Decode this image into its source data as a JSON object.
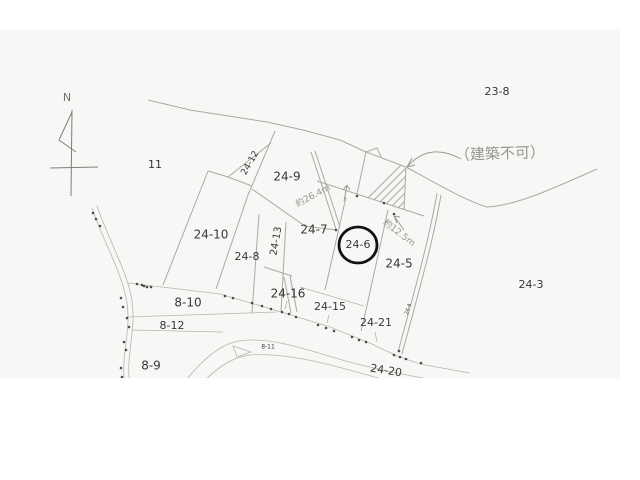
{
  "map": {
    "description": "cadastral-parcel-sketch",
    "scan_background": "#f7f7f5",
    "page_background": "#ffffff",
    "line_color": "#a9a9a5",
    "text_color": "#383836",
    "handwriting_color": "#97958e",
    "highlight_color": "#111111",
    "compass": {
      "label": "N"
    },
    "parcel_labels": [
      {
        "text": "11",
        "x": 155,
        "y": 165,
        "size": 11,
        "rotate": 0
      },
      {
        "text": "23-8",
        "x": 497,
        "y": 92,
        "size": 11,
        "rotate": 0
      },
      {
        "text": "24-12",
        "x": 250,
        "y": 163,
        "size": 9,
        "rotate": -60
      },
      {
        "text": "24-9",
        "x": 287,
        "y": 177,
        "size": 12,
        "rotate": 0
      },
      {
        "text": "24-10",
        "x": 211,
        "y": 235,
        "size": 12,
        "rotate": 0
      },
      {
        "text": "24-13",
        "x": 276,
        "y": 241,
        "size": 10,
        "rotate": -80
      },
      {
        "text": "24-8",
        "x": 247,
        "y": 257,
        "size": 11,
        "rotate": 0
      },
      {
        "text": "24-7",
        "x": 314,
        "y": 230,
        "size": 12,
        "rotate": 0
      },
      {
        "text": "24-6",
        "x": 358,
        "y": 245,
        "size": 11,
        "rotate": 0,
        "circled": true
      },
      {
        "text": "24-5",
        "x": 399,
        "y": 264,
        "size": 12,
        "rotate": 0
      },
      {
        "text": "24-3",
        "x": 531,
        "y": 285,
        "size": 11,
        "rotate": 0
      },
      {
        "text": "8-10",
        "x": 188,
        "y": 303,
        "size": 12,
        "rotate": 0
      },
      {
        "text": "24-16",
        "x": 288,
        "y": 294,
        "size": 12,
        "rotate": 0
      },
      {
        "text": "8-12",
        "x": 172,
        "y": 326,
        "size": 11,
        "rotate": 0
      },
      {
        "text": "8-9",
        "x": 151,
        "y": 366,
        "size": 12,
        "rotate": 0
      },
      {
        "text": "8-11",
        "x": 268,
        "y": 347,
        "size": 6,
        "rotate": 0
      },
      {
        "text": "24-15",
        "x": 330,
        "y": 307,
        "size": 11,
        "rotate": 0
      },
      {
        "text": "24-21",
        "x": 376,
        "y": 323,
        "size": 11,
        "rotate": 0
      },
      {
        "text": "24-20",
        "x": 386,
        "y": 371,
        "size": 11,
        "rotate": 9
      },
      {
        "text": "24-4",
        "x": 408,
        "y": 309,
        "size": 5,
        "rotate": -72
      }
    ],
    "annotations": [
      {
        "text": "（建築不可）",
        "x": 500,
        "y": 154,
        "size": 15,
        "rotate": -2
      },
      {
        "text": "約26.4m",
        "x": 313,
        "y": 196,
        "size": 9,
        "rotate": -28
      },
      {
        "text": "約12.5m",
        "x": 399,
        "y": 233,
        "size": 9,
        "rotate": 38
      }
    ],
    "highlight": {
      "target": "24-6",
      "shape": "circle",
      "cx": 358,
      "cy": 245,
      "rx": 19,
      "ry": 18
    }
  }
}
